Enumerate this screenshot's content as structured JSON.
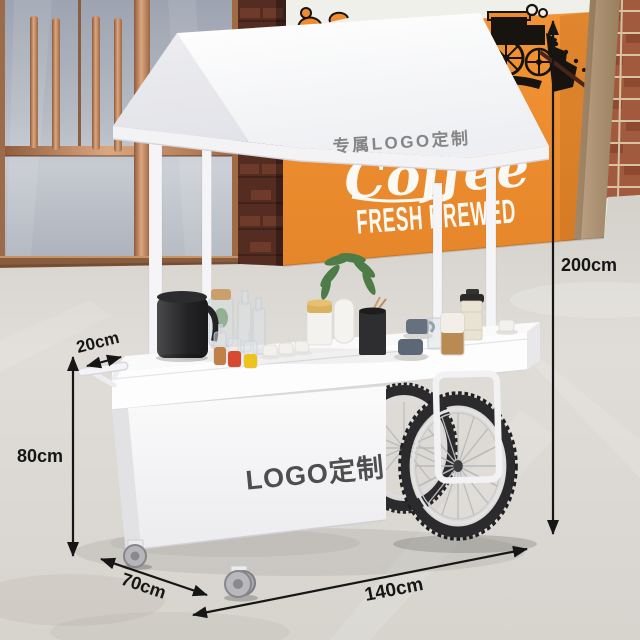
{
  "scene_title": "White mobile coffee vending cart product photo with dimension annotations",
  "canopy": {
    "label": "专属LOGO定制"
  },
  "cart_body": {
    "label": "LOGO定制"
  },
  "wall_mural": {
    "script_text": "Coffee",
    "caps_text": "FRESH BREWED"
  },
  "dimensions": {
    "total_height": "200cm",
    "tabletop_overhang": "20cm",
    "cabinet_height": "80cm",
    "base_depth": "70cm",
    "total_length": "140cm"
  },
  "colors": {
    "wall_orange": "#ee8d2f",
    "roof_white": "#fafafc",
    "annotation_black": "#161616",
    "floor_gray": "#dcd9d3",
    "copper_frame": "#b97f5c"
  }
}
